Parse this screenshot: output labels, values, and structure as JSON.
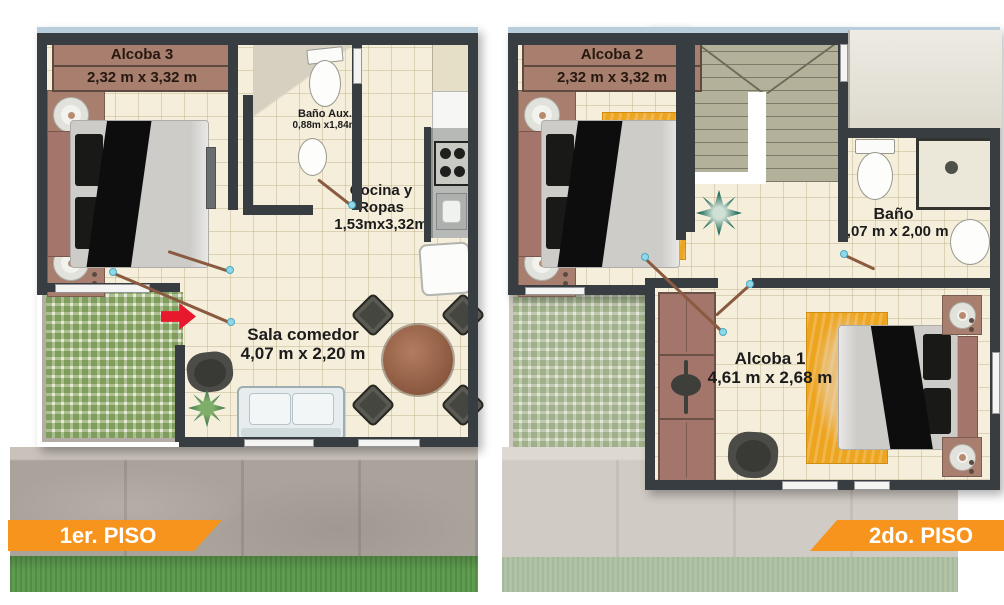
{
  "first_floor": {
    "banner": "1er. PISO",
    "rooms": {
      "alcoba3": {
        "name": "Alcoba 3",
        "dims": "2,32 m x 3,32 m"
      },
      "bano_aux": {
        "name": "Baño Aux.",
        "dims": "0,88m x1,84m"
      },
      "cocina": {
        "line1": "Cocina y",
        "line2": "Ropas",
        "dims": "1,53mx3,32m"
      },
      "sala": {
        "name": "Sala comedor",
        "dims": "4,07 m x 2,20 m"
      }
    }
  },
  "second_floor": {
    "banner": "2do. PISO",
    "rooms": {
      "alcoba2": {
        "name": "Alcoba 2",
        "dims": "2,32 m x 3,32 m"
      },
      "bano": {
        "name": "Baño",
        "dims": "2,07 m x 2,00 m"
      },
      "alcoba1": {
        "name": "Alcoba 1",
        "dims": "4,61 m x 2,68 m"
      }
    }
  },
  "colors": {
    "banner_orange": "#F7941D",
    "wall_dark": "#383D42",
    "floor_cream": "#F5EEDA",
    "label_band_brown": "#A87E6E",
    "rug_yellow": "#EDA41E",
    "entry_arrow_red": "#E8192C",
    "grass_green": "#5F9C50",
    "patio_grid_green": "#B7CC9F",
    "top_trim_blue": "#B9CEDD"
  }
}
